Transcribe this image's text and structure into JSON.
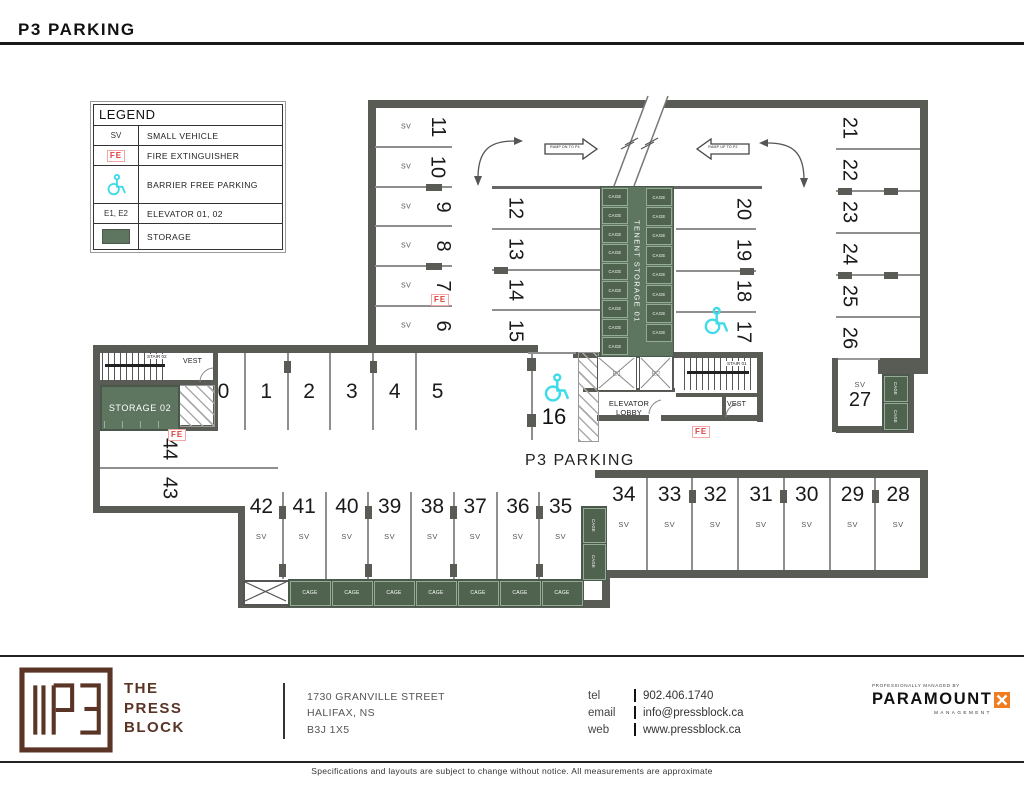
{
  "header": {
    "title": "P3 PARKING"
  },
  "legend": {
    "title": "LEGEND",
    "rows": [
      {
        "symbol": "SV",
        "label": "SMALL VEHICLE"
      },
      {
        "symbol": "FE",
        "label": "FIRE EXTINGUISHER"
      },
      {
        "symbol": "wheelchair-icon",
        "label": "BARRIER FREE PARKING"
      },
      {
        "symbol": "E1, E2",
        "label": "ELEVATOR 01, 02"
      },
      {
        "symbol": "storage-swatch",
        "label": "STORAGE"
      }
    ]
  },
  "plan": {
    "area_label": "P3 PARKING",
    "ramp_down_label": "RAMP DN TO P4",
    "ramp_up_label": "RAMP UP TO P2",
    "tenant_storage_label": "TENENT STORAGE 01",
    "storage02_label": "STORAGE 02",
    "elevator_lobby_label": "ELEVATOR LOBBY",
    "stair01_label": "STAIR 01",
    "stair02_label": "STAIR 02",
    "vest_label": "VEST",
    "e1_label": "E1",
    "e2_label": "E2",
    "fe_label": "FE",
    "sv_label": "SV",
    "stalls": {
      "col_left": [
        {
          "n": "11",
          "sv": "SV"
        },
        {
          "n": "10",
          "sv": "SV"
        },
        {
          "n": "9",
          "sv": "SV"
        },
        {
          "n": "8",
          "sv": "SV"
        },
        {
          "n": "7",
          "sv": "SV"
        },
        {
          "n": "6",
          "sv": "SV"
        }
      ],
      "col_mid": [
        "12",
        "13",
        "14",
        "15"
      ],
      "col_inner_right": [
        "20",
        "19",
        "18",
        "17"
      ],
      "col_right": [
        "21",
        "22",
        "23",
        "24",
        "25",
        "26"
      ],
      "row_mid": [
        "0",
        "1",
        "2",
        "3",
        "4",
        "5"
      ],
      "pair_left": [
        "44",
        "43"
      ],
      "stall16": "16",
      "stall27": {
        "n": "27",
        "sv": "SV"
      },
      "row_bottom_left": [
        {
          "n": "42",
          "sv": "SV"
        },
        {
          "n": "41",
          "sv": "SV"
        },
        {
          "n": "40",
          "sv": "SV"
        },
        {
          "n": "39",
          "sv": "SV"
        },
        {
          "n": "38",
          "sv": "SV"
        },
        {
          "n": "37",
          "sv": "SV"
        },
        {
          "n": "36",
          "sv": "SV"
        },
        {
          "n": "35",
          "sv": "SV"
        }
      ],
      "row_bottom_right": [
        {
          "n": "34",
          "sv": "SV"
        },
        {
          "n": "33",
          "sv": "SV"
        },
        {
          "n": "32",
          "sv": "SV"
        },
        {
          "n": "31",
          "sv": "SV"
        },
        {
          "n": "30",
          "sv": "SV"
        },
        {
          "n": "29",
          "sv": "SV"
        },
        {
          "n": "28",
          "sv": "SV"
        }
      ]
    },
    "cages": {
      "center_left": [
        "CAGE",
        "CAGE",
        "CAGE",
        "CAGE",
        "CAGE",
        "CAGE",
        "CAGE",
        "CAGE",
        "CAGE"
      ],
      "center_right": [
        "CAGE",
        "CAGE",
        "CAGE",
        "CAGE",
        "CAGE",
        "CAGE",
        "CAGE",
        "CAGE"
      ],
      "bottom_row": [
        "CAGE",
        "CAGE",
        "CAGE",
        "CAGE",
        "CAGE",
        "CAGE",
        "CAGE"
      ],
      "mid_pair": [
        "CAGE",
        "CAGE"
      ],
      "right_pair": [
        "CAGE",
        "CAGE"
      ]
    },
    "colors": {
      "wall": "#595b55",
      "storage": "#5e7660",
      "cage": "#4f634f",
      "accessible": "#3fdbe8",
      "fe": "#e03c3c"
    }
  },
  "footer": {
    "brand_lines": [
      "THE",
      "PRESS",
      "BLOCK"
    ],
    "address_lines": [
      "1730 GRANVILLE STREET",
      "HALIFAX, NS",
      "B3J 1X5"
    ],
    "contacts": [
      {
        "label": "tel",
        "value": "902.406.1740"
      },
      {
        "label": "email",
        "value": "info@pressblock.ca"
      },
      {
        "label": "web",
        "value": "www.pressblock.ca"
      }
    ],
    "managed_by": "PROFESSIONALLY MANAGED BY",
    "paramount": "PARAMOUNT",
    "management": "MANAGEMENT",
    "disclaimer": "Specifications and layouts are subject to change without notice. All measurements are approximate"
  }
}
